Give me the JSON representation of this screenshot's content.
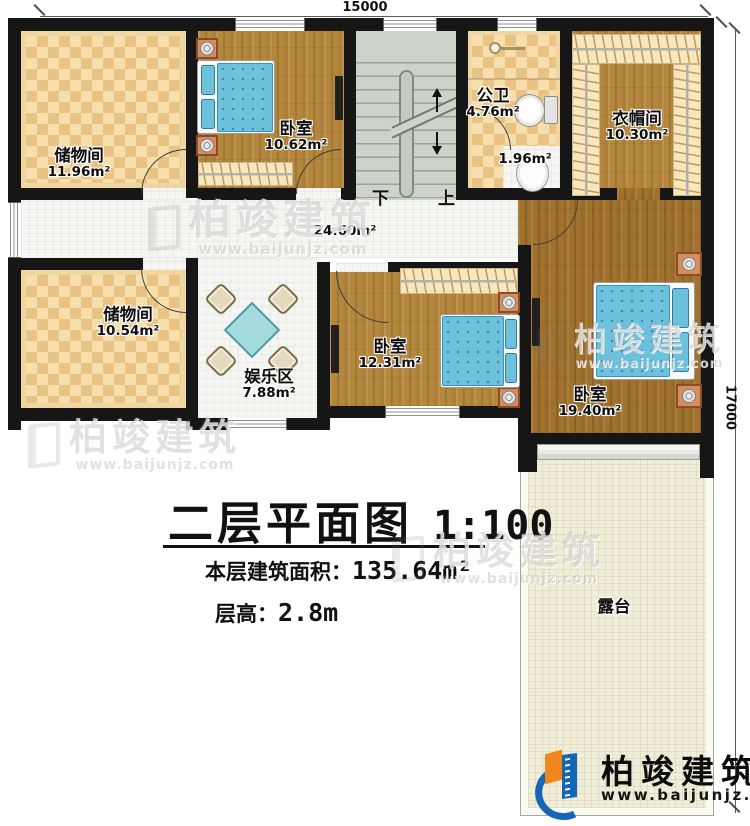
{
  "title": {
    "text": "二层平面图",
    "scale": "1:100"
  },
  "stats": [
    {
      "label": "本层建筑面积：",
      "value": "135.64m²"
    },
    {
      "label": "层高：",
      "value": "2.8m"
    }
  ],
  "dimensions": {
    "top": "15000",
    "right": "17000"
  },
  "stairs": {
    "down": "下",
    "up": "上"
  },
  "rooms": {
    "storage_tl": {
      "name": "储物间",
      "area": "11.96m²"
    },
    "bedroom_a": {
      "name": "卧室",
      "area": "10.62m²"
    },
    "bath": {
      "name": "公卫",
      "area": "4.76m²"
    },
    "wash": {
      "area": "1.96m²"
    },
    "cloak": {
      "name": "衣帽间",
      "area": "10.30m²"
    },
    "hall": {
      "area": "24.60m²"
    },
    "storage_bl": {
      "name": "储物间",
      "area": "10.54m²"
    },
    "play": {
      "name": "娱乐区",
      "area": "7.88m²"
    },
    "bedroom_b": {
      "name": "卧室",
      "area": "12.31m²"
    },
    "bedroom_c": {
      "name": "卧室",
      "area": "19.40m²"
    },
    "terrace": {
      "name": "露台"
    }
  },
  "watermark": {
    "brand": "柏竣建筑",
    "url": "www.baijunjz.com"
  },
  "logo": {
    "brand": "柏竣建筑",
    "url": "www.baijunjz.com"
  },
  "colors": {
    "wall": "#161616",
    "accent_blue": "#1766b5",
    "accent_orange": "#f0861c",
    "bed": "#6ec1dd",
    "checker_light": "#f7dfad",
    "checker_dark": "#e9c384"
  }
}
